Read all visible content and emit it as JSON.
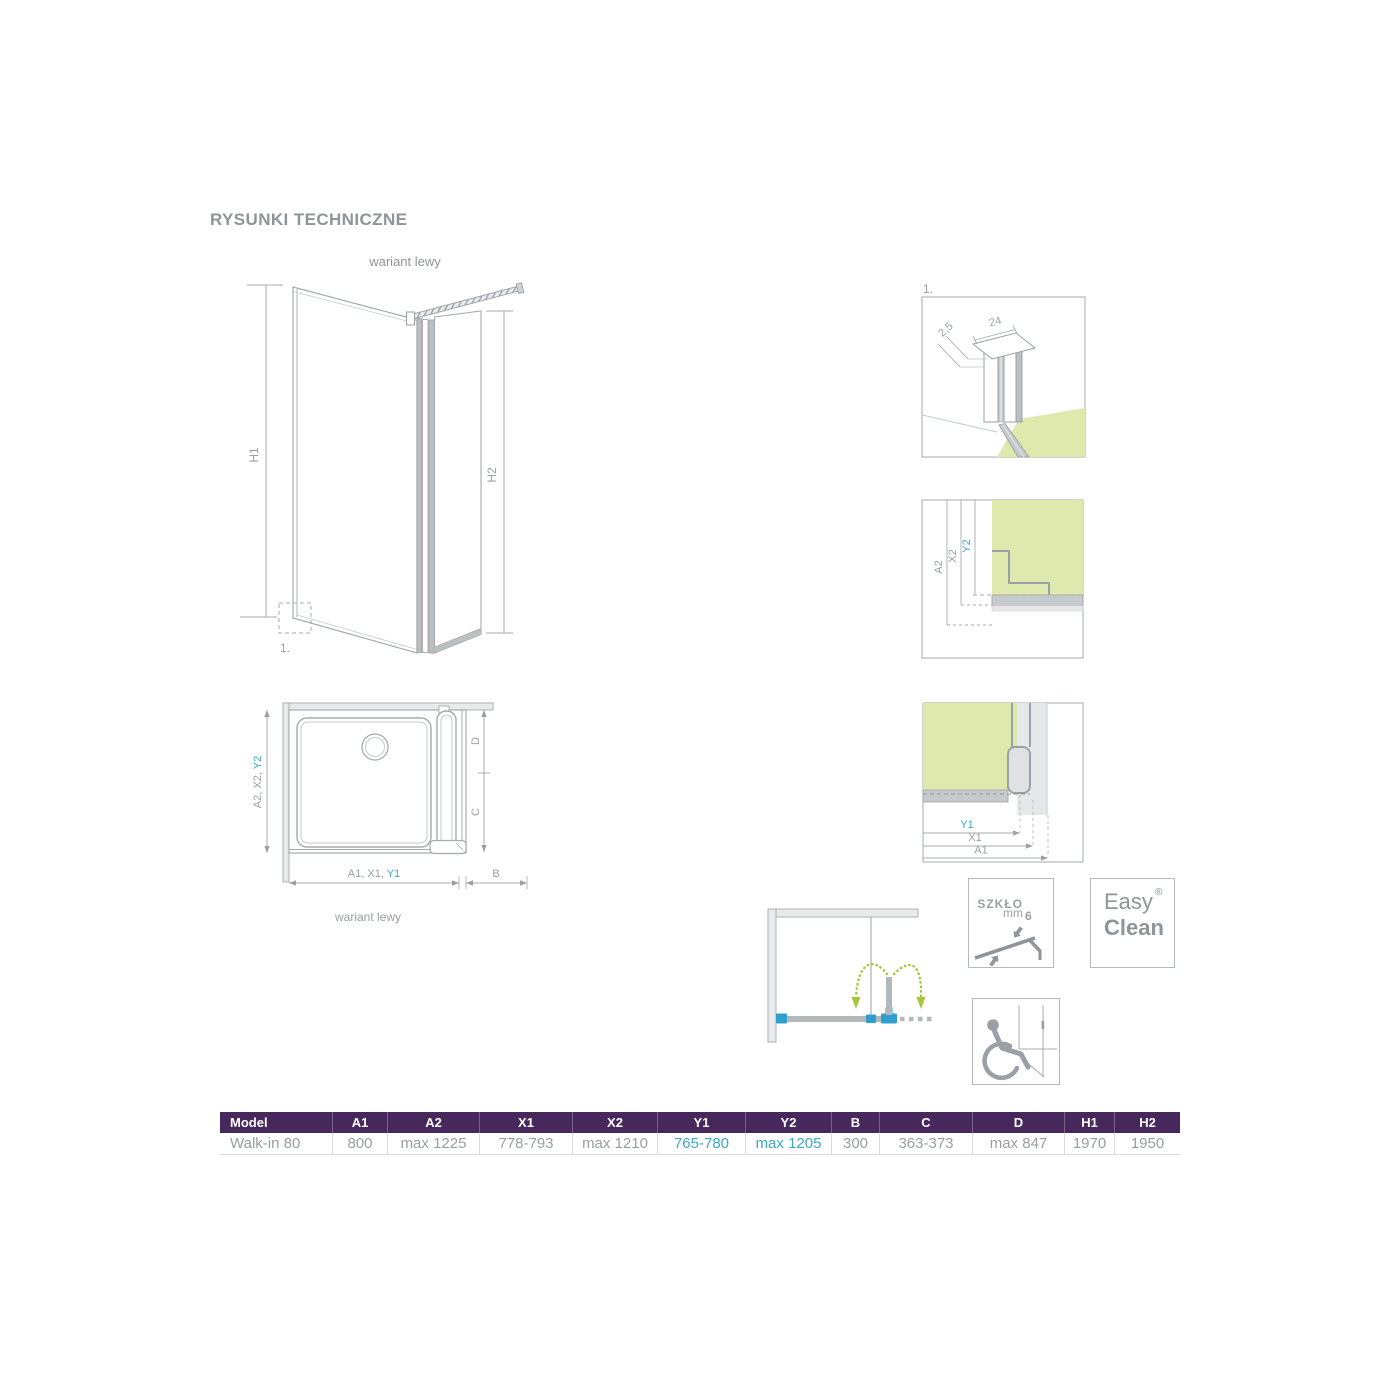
{
  "title": "RYSUNKI TECHNICZNE",
  "perspective": {
    "caption": "wariant lewy",
    "h1": "H1",
    "h2": "H2",
    "detail_ref": "1."
  },
  "plan": {
    "caption": "wariant lewy",
    "left_gray": "A2, X2, ",
    "left_teal": "Y2",
    "bottom_gray": "A1, X1, ",
    "bottom_teal": "Y1",
    "b": "B",
    "c": "C",
    "d": "D"
  },
  "detail_profile": {
    "label": "1.",
    "width_mm": "24",
    "thickness_mm": "2,5"
  },
  "detail_wall": {
    "a2": "A2",
    "x2": "X2",
    "y2": "Y2"
  },
  "detail_floor": {
    "y1": "Y1",
    "x1": "X1",
    "a1": "A1"
  },
  "badges": {
    "glass": {
      "label": "SZKŁO",
      "unit": "mm",
      "value": "6"
    },
    "easyclean": {
      "word1": "Easy",
      "word2": "Clean",
      "reg": "®"
    }
  },
  "table": {
    "headers": [
      "Model",
      "A1",
      "A2",
      "X1",
      "X2",
      "Y1",
      "Y2",
      "B",
      "C",
      "D",
      "H1",
      "H2"
    ],
    "row": [
      "Walk-in 80",
      "800",
      "max 1225",
      "778-793",
      "max 1210",
      "765-780",
      "max 1205",
      "300",
      "363-373",
      "max 847",
      "1970",
      "1950"
    ]
  },
  "colors": {
    "accent_teal": "#3aa9c2",
    "header_purple": "#46285d",
    "glass_green": "#dfe8ad",
    "arrow_green": "#a6c73a",
    "connector_blue": "#2f9fd0",
    "line_gray": "#a2a7ab",
    "text_gray": "#8f9499"
  }
}
